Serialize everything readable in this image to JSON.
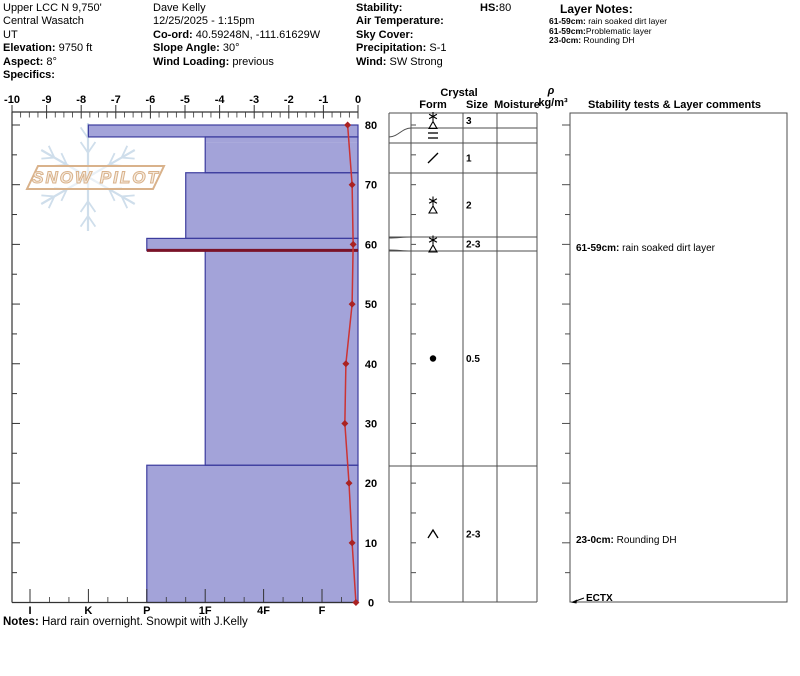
{
  "header": {
    "location_line1": "Upper LCC N 9,750'",
    "location_line2": "Central Wasatch",
    "location_line3": "UT",
    "elevation_label": "Elevation:",
    "elevation": "9750 ft",
    "aspect_label": "Aspect:",
    "aspect": "8°",
    "specifics_label": "Specifics:",
    "observer": "Dave Kelly",
    "datetime": "12/25/2025 - 1:15pm",
    "coord_label": "Co-ord:",
    "coord": "40.59248N, -111.61629W",
    "slope_angle_label": "Slope Angle:",
    "slope_angle": "30°",
    "wind_loading_label": "Wind Loading:",
    "wind_loading": "previous",
    "stability_label": "Stability:",
    "stability": "",
    "air_temp_label": "Air Temperature:",
    "air_temp": "",
    "sky_cover_label": "Sky Cover:",
    "sky_cover": "",
    "precip_label": "Precipitation:",
    "precip": "S-1",
    "wind_label": "Wind:",
    "wind": "SW Strong",
    "hs_label": "HS:",
    "hs": "80",
    "layer_notes_title": "Layer Notes:",
    "layer_notes": [
      {
        "range": "61-59cm:",
        "text": " rain soaked dirt layer"
      },
      {
        "range": "61-59cm:",
        "text": "Problematic layer"
      },
      {
        "range": "23-0cm:",
        "text": " Rounding DH"
      }
    ]
  },
  "notes": {
    "label": "Notes:",
    "text": " Hard rain overnight.  Snowpit with J.Kelly"
  },
  "watermark": {
    "text": "SNOW PILOT",
    "snowflake_color": "#cfdeeb",
    "logo_color": "#d9b28b"
  },
  "table": {
    "crystal_label": "Crystal",
    "form_label": "Form",
    "size_label": "Size",
    "moisture_label": "Moisture",
    "density_rho": "ρ",
    "density_unit": "kg/m³",
    "comments_label": "Stability tests & Layer comments",
    "comments": [
      {
        "bold": "61-59cm:",
        "text": " rain soaked dirt layer"
      },
      {
        "bold": "23-0cm:",
        "text": " Rounding DH"
      }
    ],
    "test_result": "ECTX"
  },
  "chart_data": {
    "type": "snow-profile",
    "temp_axis": {
      "unit": "°C",
      "min": -10,
      "max": 0,
      "major_ticks": [
        -10,
        -9,
        -8,
        -7,
        -6,
        -5,
        -4,
        -3,
        -2,
        -1,
        0
      ],
      "minor_step": 0.25
    },
    "hardness_axis": {
      "categories": [
        "I",
        "K",
        "P",
        "1F",
        "4F",
        "F"
      ]
    },
    "depth_axis": {
      "unit": "cm",
      "max": 80,
      "label_step": 10,
      "tick_step": 5,
      "labels": [
        0,
        10,
        20,
        30,
        40,
        50,
        60,
        70,
        80
      ]
    },
    "layers": [
      {
        "top": 80,
        "bottom": 78,
        "hardness": "K",
        "form": "stellar",
        "size": "3"
      },
      {
        "top": 78,
        "bottom": 77,
        "hardness": "1F",
        "form": "ice-lens",
        "size": ""
      },
      {
        "top": 77,
        "bottom": 72,
        "hardness": "1F",
        "form": "decomposing",
        "size": "1"
      },
      {
        "top": 72,
        "bottom": 61,
        "hardness": "1F+",
        "form": "stellar",
        "size": "2"
      },
      {
        "top": 61,
        "bottom": 59,
        "hardness": "P",
        "form": "stellar",
        "size": "2-3",
        "flagged": true
      },
      {
        "top": 59,
        "bottom": 23,
        "hardness": "1F",
        "form": "rounded",
        "size": "0.5"
      },
      {
        "top": 23,
        "bottom": 0,
        "hardness": "P",
        "form": "depth-hoar",
        "size": "2-3"
      }
    ],
    "temperature_profile": [
      {
        "depth": 80,
        "temp": -0.3
      },
      {
        "depth": 70,
        "temp": -0.17
      },
      {
        "depth": 60,
        "temp": -0.14
      },
      {
        "depth": 50,
        "temp": -0.17
      },
      {
        "depth": 40,
        "temp": -0.35
      },
      {
        "depth": 30,
        "temp": -0.38
      },
      {
        "depth": 20,
        "temp": -0.26
      },
      {
        "depth": 10,
        "temp": -0.17
      },
      {
        "depth": 0,
        "temp": -0.06
      }
    ],
    "colors": {
      "bar_fill": "#a3a3d9",
      "bar_border": "#3c3c9e",
      "flagged_layer": "#7a1228",
      "temp_line": "#cc3333",
      "temp_marker": "#aa2222",
      "axis": "#333333",
      "table_line": "#4d4d4d"
    }
  }
}
